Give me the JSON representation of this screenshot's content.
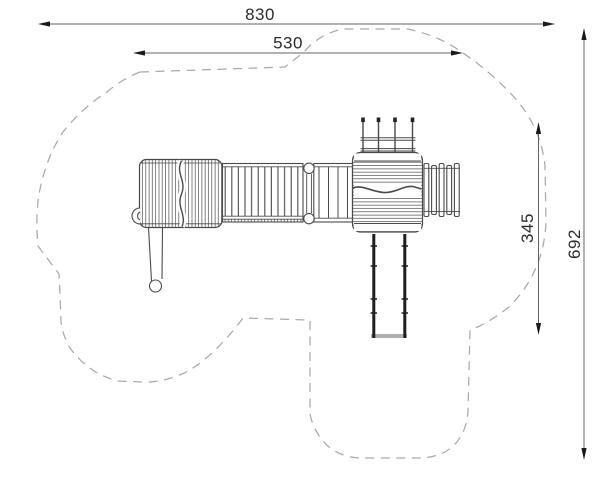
{
  "drawing": {
    "kind": "playground-equipment-plan-top-view",
    "canvas": {
      "width": 600,
      "height": 480,
      "background": "#ffffff"
    },
    "colors": {
      "equipment_line": "#4a4a4a",
      "safety_zone_dash": "#a9a9a9",
      "dimension_line": "#636363",
      "dimension_arrow": "#1a1a1a",
      "dimension_text": "#2b2b2b",
      "slide_rail": "#1f1f1f",
      "slide_end_bar": "#b0b0b0"
    },
    "dimensions": {
      "total_width": {
        "value": "830",
        "orientation": "horizontal"
      },
      "equipment_width": {
        "value": "530",
        "orientation": "horizontal"
      },
      "equipment_depth": {
        "value": "345",
        "orientation": "vertical"
      },
      "total_depth": {
        "value": "692",
        "orientation": "vertical"
      }
    },
    "components": [
      "safety-zone-outline",
      "left-tower-roof",
      "play-counter",
      "fireman-pole",
      "bridge",
      "post-pair",
      "ramp",
      "main-tower-roof",
      "climbing-frame",
      "vertical-climber",
      "slide"
    ]
  }
}
